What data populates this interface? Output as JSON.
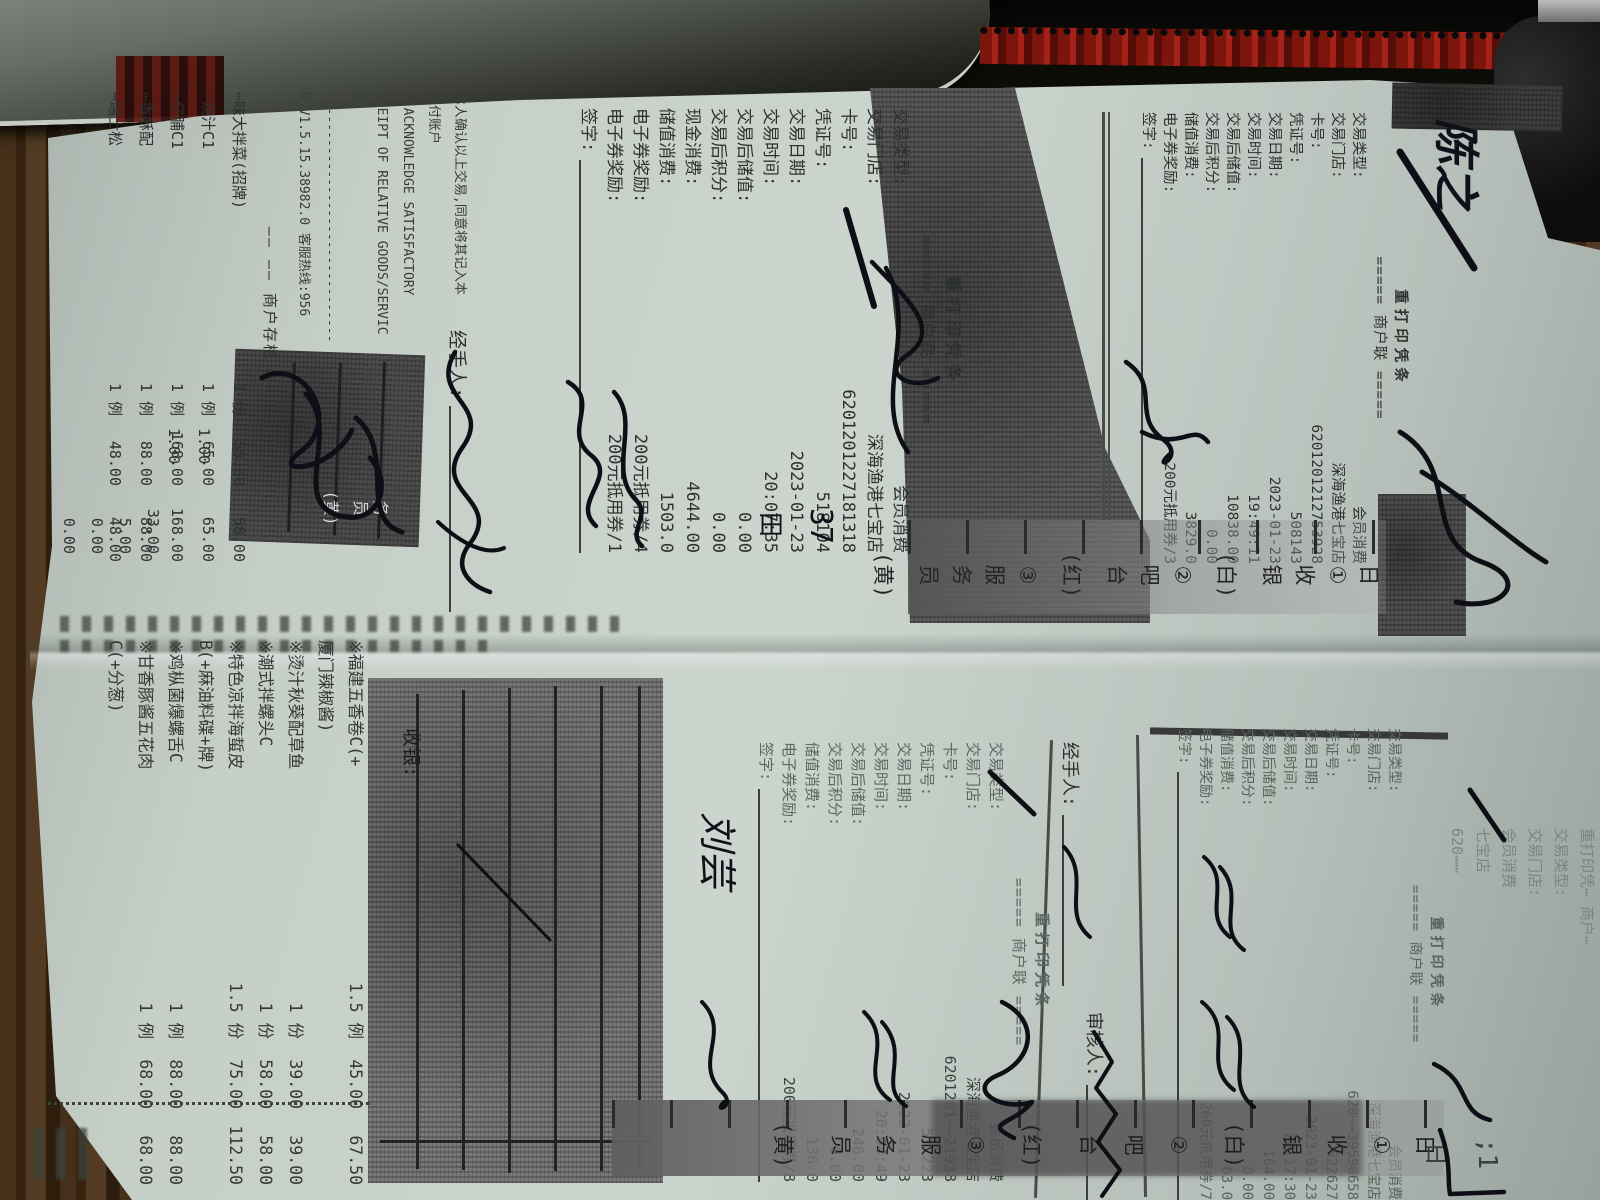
{
  "labels": {
    "qianzi": "签字:",
    "jingshouren": "经手人:",
    "shenheren": "审核人:",
    "shouyin": "收银:"
  },
  "stub": {
    "separator": "—— —— 商户存根 —— ——",
    "items": [
      {
        "name": "⋯味大拌菜(招牌)",
        "qty": "1 份",
        "price": "58.00",
        "total": "58.00"
      },
      {
        "name": "⋯烧汁C1",
        "qty": "1 例",
        "price": "65.00",
        "total": "65.00"
      },
      {
        "name": "⋯仔脯C1",
        "qty": "1 例",
        "price": "168.00",
        "total": "168.00"
      },
      {
        "name": "⋯香酥配",
        "qty": "1 例",
        "price": "88.00",
        "total": "88.00"
      },
      {
        "name": "⋯瑞士松",
        "qty": "1 例",
        "price": "48.00",
        "total": "48.00"
      }
    ],
    "extra_rows": [
      {
        "q": "1.00",
        "a": "33.00"
      },
      {
        "q": "1.00",
        "a": "5.00"
      },
      {
        "q": "",
        "a": "0.00"
      },
      {
        "q": "",
        "a": "0.00"
      }
    ]
  },
  "disclaimer": {
    "lines": [
      "本人确认以上交易,同意将其记入本",
      "支付账户",
      ": ACKNOWLEDGE SATISFACTORY",
      "ECEIPT OF RELATIVE GOODS/SERVIC",
      "S",
      "--------------------------------",
      "D_V1.5.15.38982.0  客服热线:956"
    ]
  },
  "receipts": {
    "r518104": {
      "title": "重打印凭条",
      "copy": "===== 商户联 =====",
      "fields": [
        {
          "label": "交易类型:",
          "value": "会员消费"
        },
        {
          "label": "交易门店:",
          "value": "深海渔港七宝店"
        },
        {
          "label": "卡号:",
          "value": "6201201227181318"
        },
        {
          "label": "凭证号:",
          "value": "518104"
        },
        {
          "label": "交易日期:",
          "value": "2023-01-23"
        },
        {
          "label": "交易时间:",
          "value": "20:07:35"
        },
        {
          "label": "交易后储值:",
          "value": "0.00"
        },
        {
          "label": "交易后积分:",
          "value": "0.00"
        },
        {
          "label": "现金消费:",
          "value": "4644.00"
        },
        {
          "label": "储值消费:",
          "value": "1503.0"
        },
        {
          "label": "电子券奖励:",
          "value": "200元抵用券/4"
        },
        {
          "label": "电子券奖励:",
          "value": "200元抵用券/1"
        }
      ]
    },
    "r508143": {
      "title": "重打印凭条",
      "copy": "===== 商户联 =====",
      "fields": [
        {
          "label": "交易类型:",
          "value": "会员消费"
        },
        {
          "label": "交易门店:",
          "value": "深海渔港七宝店"
        },
        {
          "label": "卡号:",
          "value": "6201201212753928"
        },
        {
          "label": "凭证号:",
          "value": "508143"
        },
        {
          "label": "交易日期:",
          "value": "2023-01-23"
        },
        {
          "label": "交易时间:",
          "value": "19:49:11"
        },
        {
          "label": "交易后储值:",
          "value": "10838.00"
        },
        {
          "label": "交易后积分:",
          "value": "0.00"
        },
        {
          "label": "储值消费:",
          "value": "3829.0"
        },
        {
          "label": "电子券奖励:",
          "value": "200元抵用券/3"
        }
      ]
    },
    "r537223": {
      "title": "重打印凭条",
      "copy": "===== 商户联 =====",
      "fields": [
        {
          "label": "交易类型:",
          "value": "会员消费"
        },
        {
          "label": "交易门店:",
          "value": "深海渔港七宝店"
        },
        {
          "label": "卡号:",
          "value": "6201201⋯⋯21938"
        },
        {
          "label": "凭证号:",
          "value": "537223"
        },
        {
          "label": "交易日期:",
          "value": "2023-01-23"
        },
        {
          "label": "交易时间:",
          "value": "20:04:49"
        },
        {
          "label": "交易后储值:",
          "value": "246.00"
        },
        {
          "label": "交易后积分:",
          "value": "0.00"
        },
        {
          "label": "储值消费:",
          "value": "136.0"
        },
        {
          "label": "电子券奖励:",
          "value": "200元抵用券/8"
        }
      ]
    },
    "r522627": {
      "title": "重打印凭条",
      "copy": "===== 商户联 =====",
      "fields": [
        {
          "label": "交易类型:",
          "value": "会员消费"
        },
        {
          "label": "交易门店:",
          "value": "深海渔港七宝店"
        },
        {
          "label": "卡号:",
          "value": "620⋯⋯39590658"
        },
        {
          "label": "凭证号:",
          "value": "522627"
        },
        {
          "label": "交易日期:",
          "value": "2023-01-23"
        },
        {
          "label": "交易时间:",
          "value": "20:17:30"
        },
        {
          "label": "交易后储值:",
          "value": "164.00"
        },
        {
          "label": "交易后积分:",
          "value": "0.00"
        },
        {
          "label": "储值消费:",
          "value": "63.0"
        },
        {
          "label": "电子券奖励:",
          "value": "200元抵用券/7"
        }
      ]
    }
  },
  "order": {
    "items": [
      {
        "name": "※福建五香卷C(+",
        "qty": "1.5 例",
        "price": "45.00",
        "total": "67.50"
      },
      {
        "name": "  厦门辣椒酱)",
        "qty": "",
        "price": "",
        "total": ""
      },
      {
        "name": "※烫汁秋葵配草鱼",
        "qty": "1 份",
        "price": "39.00",
        "total": "39.00"
      },
      {
        "name": "※潮式拌螺头C",
        "qty": "1 份",
        "price": "58.00",
        "total": "58.00"
      },
      {
        "name": "※特色凉拌海蜇皮",
        "qty": "1.5 份",
        "price": "75.00",
        "total": "112.50"
      },
      {
        "name": "B(+麻油料碟+牌)",
        "qty": "",
        "price": "",
        "total": ""
      },
      {
        "name": "※鸡枞菌爆螺舌C",
        "qty": "1 例",
        "price": "88.00",
        "total": "88.00"
      },
      {
        "name": "※甘香豚酱五花肉",
        "qty": "1 例",
        "price": "68.00",
        "total": "68.00"
      },
      {
        "name": "C(+分葱)",
        "qty": "",
        "price": "",
        "total": ""
      }
    ]
  },
  "partial_receipt": {
    "lines": [
      "重打印凭⋯  商户⋯",
      "交易类型:",
      "交易门店:",
      "会员消费",
      "七宝店",
      "620⋯⋯"
    ]
  },
  "legend": {
    "chars": [
      "日",
      "①",
      "收",
      "银",
      "(白)",
      "②",
      "吧",
      "台",
      "(红)",
      "③",
      "服",
      "务",
      "员",
      "(黄)"
    ]
  },
  "staff_hint": {
    "chars": [
      "务",
      "员",
      "(黄)"
    ]
  },
  "handwriting": {
    "name_top_right": "陈之",
    "name_liu": "刘芸",
    "table_number": "37",
    "table_char": "田",
    "mark_ri": "日",
    "mark_one": ";1"
  }
}
